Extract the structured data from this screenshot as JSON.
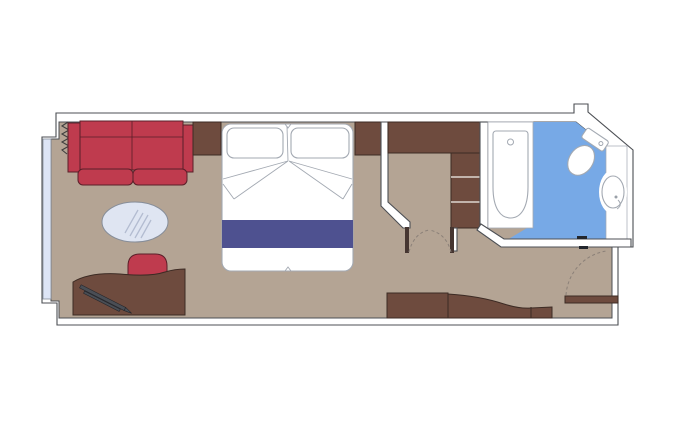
{
  "plan": {
    "type": "floorplan",
    "subject": "cruise-ship-stateroom-cabin",
    "visible_text": [],
    "elements": [
      "balcony-window",
      "curtain",
      "sofa",
      "side-table",
      "coffee-table",
      "desk",
      "desk-chair",
      "pen",
      "double-bed",
      "pillow-left",
      "pillow-right",
      "bed-runner",
      "nightstand",
      "bedroom-partition-wall",
      "wardrobe",
      "shelf-unit",
      "double-swing-door",
      "bathroom",
      "bathtub",
      "toilet",
      "sink",
      "sink-counter",
      "bathroom-door-pivot",
      "entrance-door",
      "entrance-door-swing",
      "sideboard",
      "vestibule"
    ]
  },
  "colors": {
    "floor": "#b4a494",
    "wall_fill": "#ffffff",
    "wall_line": "#4c4f54",
    "wood": "#6e4b3e",
    "wood_line": "#3c2b24",
    "sofa_red": "#bf3b4e",
    "red_line": "#5a1f29",
    "navy": "#4e5190",
    "bath_blue": "#77a9e6",
    "glass": "#dde5f6",
    "fixture_line": "#a3a9b2",
    "table_fill": "#dfe5f2",
    "table_line": "#868d99",
    "dash": "#8b8078",
    "jamb": "#463631"
  }
}
